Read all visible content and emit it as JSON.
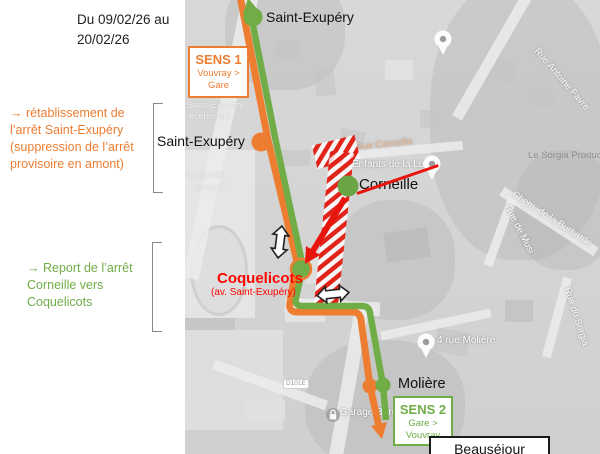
{
  "colors": {
    "orange": "#ED7D31",
    "green": "#70AD47",
    "red": "#FF0600",
    "hatch_red": "#E2231A",
    "map_gray": "#D6D6D6"
  },
  "header": {
    "date_line1": "Du 09/02/26 au",
    "date_line2": "20/02/26"
  },
  "notes": {
    "orange_note": "→ rétablissement de l’arrêt Saint-Exupéry (suppression de l’arrêt provisoire en amont)",
    "green_note": "→ Report de l’arrêt Corneille vers Coquelicots"
  },
  "direction_badges": {
    "sens1": {
      "title": "SENS 1",
      "line1": "Vouvray >",
      "line2": "Gare"
    },
    "sens2": {
      "title": "SENS 2",
      "line1": "Gare >",
      "line2": "Vouvray"
    }
  },
  "stops": {
    "saint_exupery_top": "Saint-Exupéry",
    "saint_exupery_left": "Saint-Exupéry",
    "corneille": "Corneille",
    "coquelicots": "Coquelicots",
    "coquelicots_sub": "(av. Saint-Exupéry)",
    "moliere": "Molière",
    "beausejour": "Beauséjour"
  },
  "map_labels": [
    {
      "text": "Rue Antoine Favre"
    },
    {
      "text": "Le Sorgia Producti"
    },
    {
      "text": "Chem. de la Burbarde"
    },
    {
      "text": "Rue de Musi"
    },
    {
      "text": "Rue Corneille"
    },
    {
      "text": "Enfants de la Lune"
    },
    {
      "text": "Saint-Exupéry"
    },
    {
      "text": "écemment"
    },
    {
      "text": "xe Sportif"
    },
    {
      "text": "Jacquet"
    },
    {
      "text": "Garage Bernar"
    },
    {
      "text": "4 rue Molière"
    },
    {
      "text": "Rue du Sorgia"
    },
    {
      "text": "D101E"
    }
  ]
}
